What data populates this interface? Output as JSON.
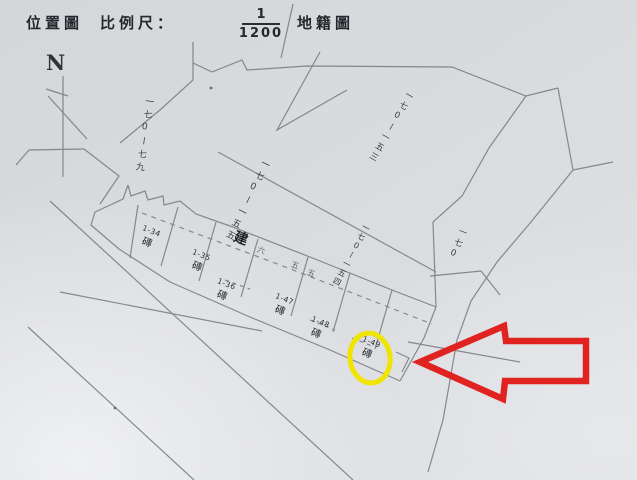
{
  "header": {
    "title_left": "位置圖",
    "scale_label": "比例尺：",
    "scale_fraction": {
      "numerator": "1",
      "denominator": "1200"
    },
    "title_right": "地籍圖"
  },
  "compass": {
    "north_label": "N"
  },
  "map": {
    "lot_numbers": [
      {
        "id": "170-79",
        "text": "一七0ー七九"
      },
      {
        "id": "170-155",
        "text": "一七0ー一五五"
      },
      {
        "id": "170-154",
        "text": "一七0ー一五四"
      },
      {
        "id": "170-153",
        "text": "一七0ー一五三"
      },
      {
        "id": "170",
        "text": "一七0"
      }
    ],
    "road_label": {
      "lead_char": "建",
      "trail_chars": [
        "六",
        "五",
        "五"
      ]
    },
    "parcels": [
      {
        "number": "1-34",
        "material": "磚",
        "highlighted": false
      },
      {
        "number": "1-35",
        "material": "磚",
        "highlighted": false
      },
      {
        "number": "1-36",
        "material": "磚",
        "highlighted": false
      },
      {
        "number": "1-47",
        "material": "磚",
        "highlighted": false
      },
      {
        "number": "1-48",
        "material": "磚",
        "highlighted": false
      },
      {
        "number": "1-49",
        "material": "磚",
        "highlighted": true
      }
    ],
    "annotations": {
      "highlight_circle": {
        "shape": "ellipse",
        "color": "#f0e400",
        "marks_parcel": "1-49"
      },
      "pointer_arrow": {
        "color": "#e02220",
        "direction": "left"
      }
    },
    "colors": {
      "paper": "#dadcdf",
      "line": "#6f7277",
      "ink": "#2e3136"
    }
  }
}
